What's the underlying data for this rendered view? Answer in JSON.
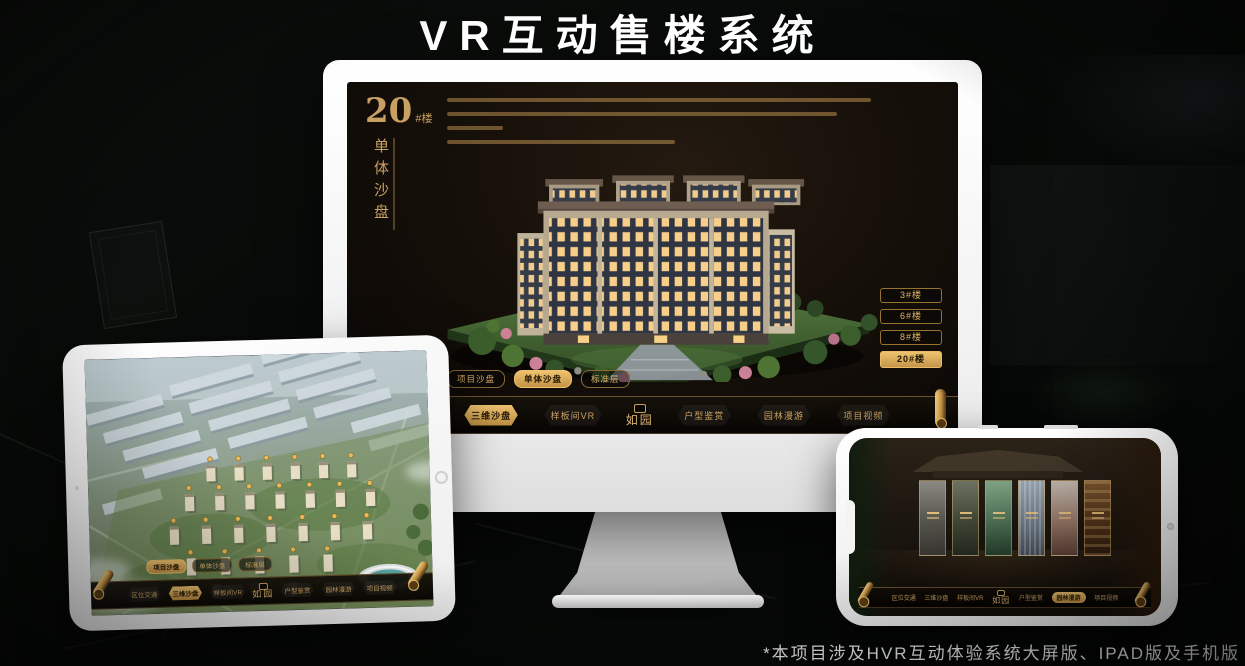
{
  "page": {
    "title": "VR互动售楼系统",
    "footnote": "*本项目涉及HVR互动体验系统大屏版、IPAD版及手机版"
  },
  "colors": {
    "accent_gold": "#c9a063",
    "active_gold": "#eec26f",
    "screen_background": "#140f09"
  },
  "nav_menu": {
    "logo": "如园",
    "items": [
      "区位交通",
      "三维沙盘",
      "样板间VR",
      "户型鉴赏",
      "园林漫游",
      "项目视频"
    ]
  },
  "monitor": {
    "block_number": "20",
    "block_suffix": "#楼",
    "block_title_vertical": "单体沙盘",
    "floor_buttons": [
      {
        "label": "3#楼",
        "active": false
      },
      {
        "label": "6#楼",
        "active": false
      },
      {
        "label": "8#楼",
        "active": false
      },
      {
        "label": "20#楼",
        "active": true
      }
    ],
    "sub_tabs": [
      {
        "label": "项目沙盘",
        "active": false
      },
      {
        "label": "单体沙盘",
        "active": true
      },
      {
        "label": "标准层",
        "active": false
      }
    ],
    "nav_active_item": "三维沙盘"
  },
  "tablet": {
    "sub_tabs": [
      {
        "label": "项目沙盘",
        "active": true
      },
      {
        "label": "单体沙盘",
        "active": false
      },
      {
        "label": "标准层",
        "active": false
      }
    ],
    "nav_active_item": "三维沙盘"
  },
  "phone": {
    "nav_active_item": "园林漫游",
    "gallery_card_count": 6
  }
}
